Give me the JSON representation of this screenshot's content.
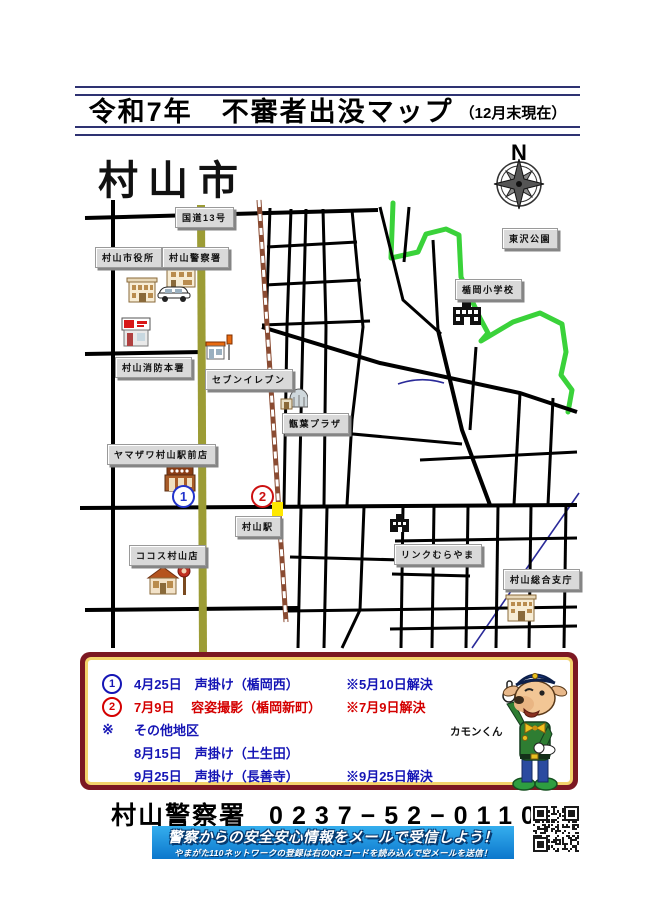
{
  "title": {
    "main": "令和7年　不審者出没マップ",
    "suffix": "（12月末現在）"
  },
  "map": {
    "city_name": "村山市",
    "compass_label": "N",
    "labels": [
      {
        "id": "route-13",
        "text": "国道13号"
      },
      {
        "id": "city-hall",
        "text": "村山市役所"
      },
      {
        "id": "police-station",
        "text": "村山警察署"
      },
      {
        "id": "fire-station",
        "text": "村山消防本署"
      },
      {
        "id": "seven-eleven",
        "text": "セブンイレブン"
      },
      {
        "id": "yamazawa",
        "text": "ヤマザワ村山駅前店"
      },
      {
        "id": "cocos",
        "text": "ココス村山店"
      },
      {
        "id": "shoyo-plaza",
        "text": "甑葉プラザ"
      },
      {
        "id": "murayama-sta",
        "text": "村山駅"
      },
      {
        "id": "higashizawa-park",
        "text": "東沢公園"
      },
      {
        "id": "tateoka-elem",
        "text": "楯岡小学校"
      },
      {
        "id": "link-murayama",
        "text": "リンクむらやま"
      },
      {
        "id": "sogo-shicho",
        "text": "村山総合支庁"
      }
    ],
    "markers": [
      {
        "no": "1",
        "color": "blue"
      },
      {
        "no": "2",
        "color": "red"
      }
    ]
  },
  "incidents": {
    "items": [
      {
        "no": "1",
        "text": "4月25日　声掛け（楯岡西）",
        "note": "※5月10日解決"
      },
      {
        "no": "2",
        "text": "7月9日　 容姿撮影（楯岡新町）",
        "note": "※7月9日解決"
      },
      {
        "sym": "※",
        "text": "その他地区",
        "note": ""
      },
      {
        "text": "8月15日　声掛け（土生田）",
        "note": ""
      },
      {
        "text": "9月25日　声掛け（長善寺）",
        "note": "※9月25日解決"
      }
    ],
    "mascot_name": "カモンくん"
  },
  "footer": {
    "police_name": "村山警察署",
    "phone": "0237−52−0110",
    "banner_line1": "警察からの安全安心情報をメールで受信しよう！",
    "banner_line2": "やまがた110ネットワークの登録は右のQRコードを読み込んで空メールを送信！"
  },
  "colors": {
    "title_rule": "#2e3272",
    "box_border_maroon": "#7c1822",
    "box_inner_gold": "#f3d36b",
    "incident_blue": "#1515b5",
    "incident_red": "#d40000",
    "banner_blue": "#1593dd",
    "route13_olive": "#9c9c35",
    "railway_brown": "#8a4b32",
    "boundary_green": "#3ad23a",
    "river_blue": "#2a2a99",
    "crossing_yellow": "#ffe800"
  }
}
